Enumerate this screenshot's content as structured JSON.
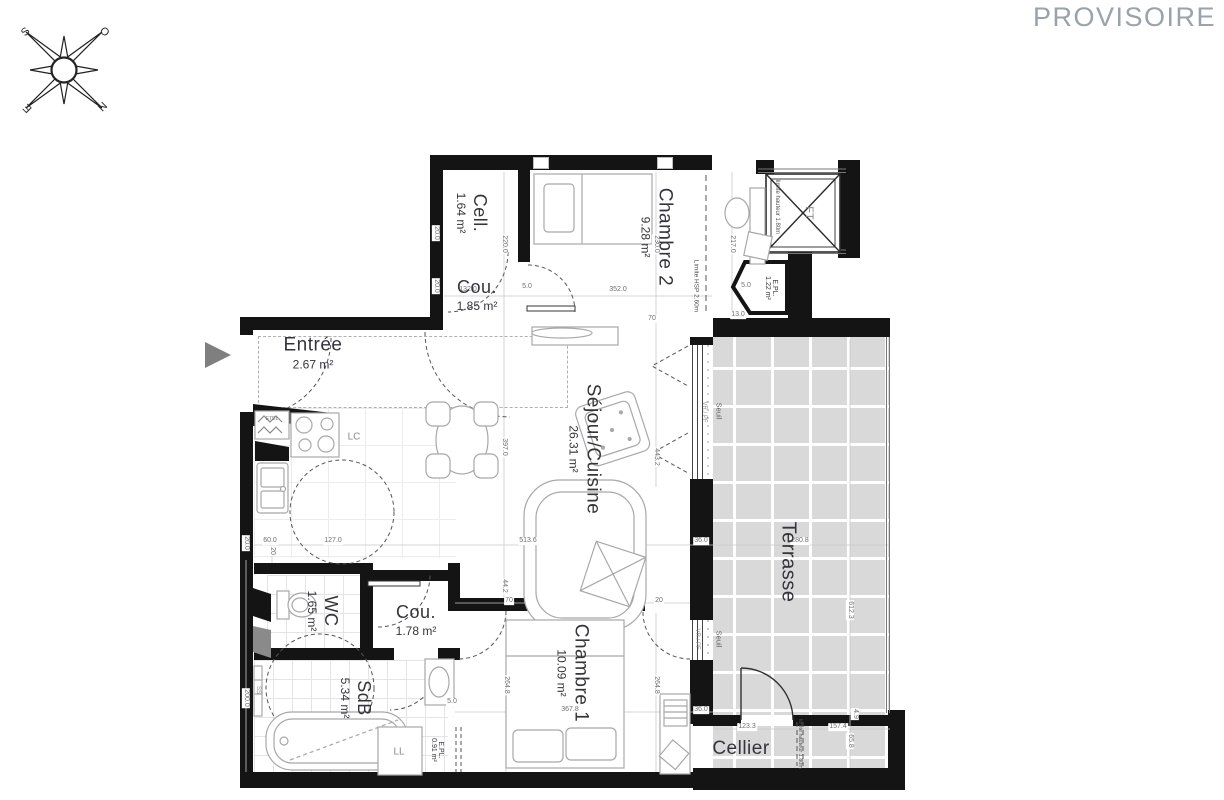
{
  "watermark": "PROVISOIRE",
  "compass": {
    "n": "N",
    "s": "S",
    "e": "E",
    "o": "O"
  },
  "rooms": {
    "cell": {
      "name": "Cell.",
      "area": "1.64 m²"
    },
    "chambre2": {
      "name": "Chambre 2",
      "area": "9.28 m²"
    },
    "cou1": {
      "name": "Cou.",
      "area": "1.85 m²"
    },
    "entree": {
      "name": "Entrée",
      "area": "2.67 m²"
    },
    "sejour": {
      "name": "Séjour/Cuisine",
      "area": "26.31 m²"
    },
    "wc": {
      "name": "WC",
      "area": "1.65 m²"
    },
    "cou2": {
      "name": "Cou.",
      "area": "1.78 m²"
    },
    "sdb": {
      "name": "SdB",
      "area": "5.34 m²"
    },
    "chambre1": {
      "name": "Chambre 1",
      "area": "10.09 m²"
    },
    "terrasse": {
      "name": "Terrasse"
    },
    "cellier": {
      "name": "Cellier"
    },
    "epl_chambre2": {
      "name": "E.PL.",
      "area": "1.22 m²"
    },
    "epl_sdb": {
      "name": "E.PL.",
      "area": "0.91 m²"
    }
  },
  "labels": {
    "ft": "FT",
    "lc": "LC",
    "ll": "LL",
    "ss": "SS",
    "etel": "ETEL",
    "vr_pf": "VR / PF",
    "seuil": "Seuil",
    "limite_hsp": "Limite HSP 2.60m",
    "limite_hauteur": "limite hauteur 1.80m"
  },
  "dims": [
    "132.0",
    "5.0",
    "352.0",
    "20.0",
    "20.0",
    "220.0",
    "230.0",
    "217.0",
    "13.0",
    "70",
    "5.0",
    "397.0",
    "443.2",
    "60.0",
    "127.0",
    "513.6",
    "36.0",
    "280.8",
    "612.3",
    "20",
    "44.2",
    "70",
    "20",
    "264.8",
    "264.8",
    "367.8",
    "36.0",
    "5.0",
    "123.3",
    "157.4",
    "65.8",
    "4.9",
    "200.0",
    "20.0"
  ]
}
